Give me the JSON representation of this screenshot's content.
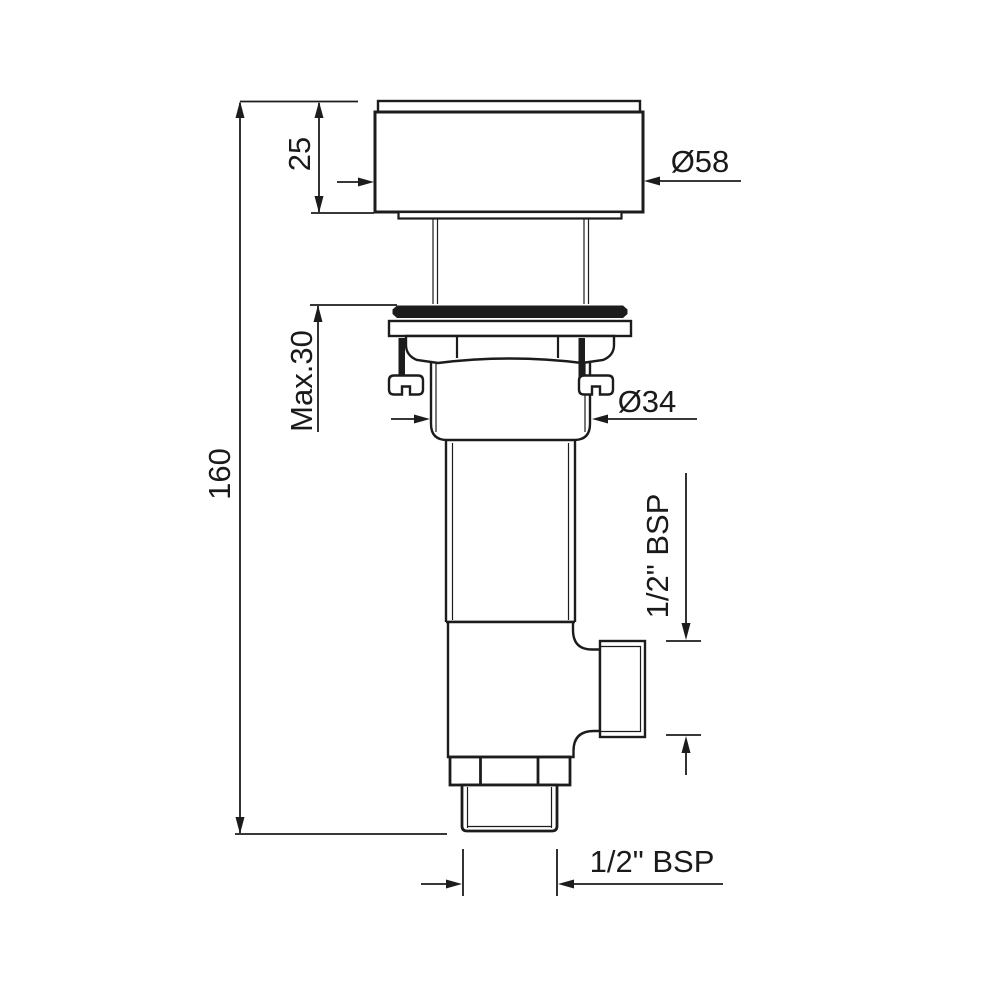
{
  "drawing": {
    "kind": "technical-drawing",
    "subject": "basin waste drain valve - side elevation with dimensions",
    "background_color": "#ffffff",
    "line_color": "#1c1c1c",
    "dims": {
      "cap_height": "25",
      "cap_diameter": "Ø58",
      "max_panel_thickness": "Max.30",
      "overall_height": "160",
      "body_diameter": "Ø34",
      "side_outlet_thread": "1/2\" BSP",
      "bottom_outlet_thread": "1/2\" BSP"
    }
  }
}
